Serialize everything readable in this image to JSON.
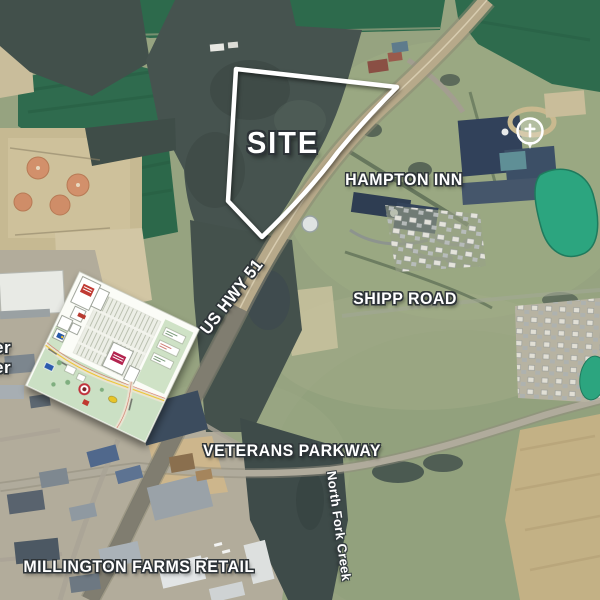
{
  "map": {
    "labels": {
      "site": "SITE",
      "hampton_inn": "HAMPTON INN",
      "shipp_road": "SHIPP ROAD",
      "us_hwy_51": "US HWY 51",
      "veterans_parkway": "VETERANS PARKWAY",
      "millington_farms_retail": "MILLINGTON FARMS RETAIL",
      "north_fork_creek": "North Fork Creek",
      "left_edge_partial_top": "er",
      "left_edge_partial_bottom": "er"
    },
    "colors": {
      "label_text": "#ffffff",
      "label_outline": "#2e3438",
      "site_boundary": "#ffffff",
      "pond": "#2ca57f",
      "dark_field": "#2f6b4e",
      "open_field": "#95a37f",
      "woods": "#46534f",
      "highway": "#b7a98a"
    },
    "icons": {
      "church_marker": "cross-in-circle"
    }
  }
}
